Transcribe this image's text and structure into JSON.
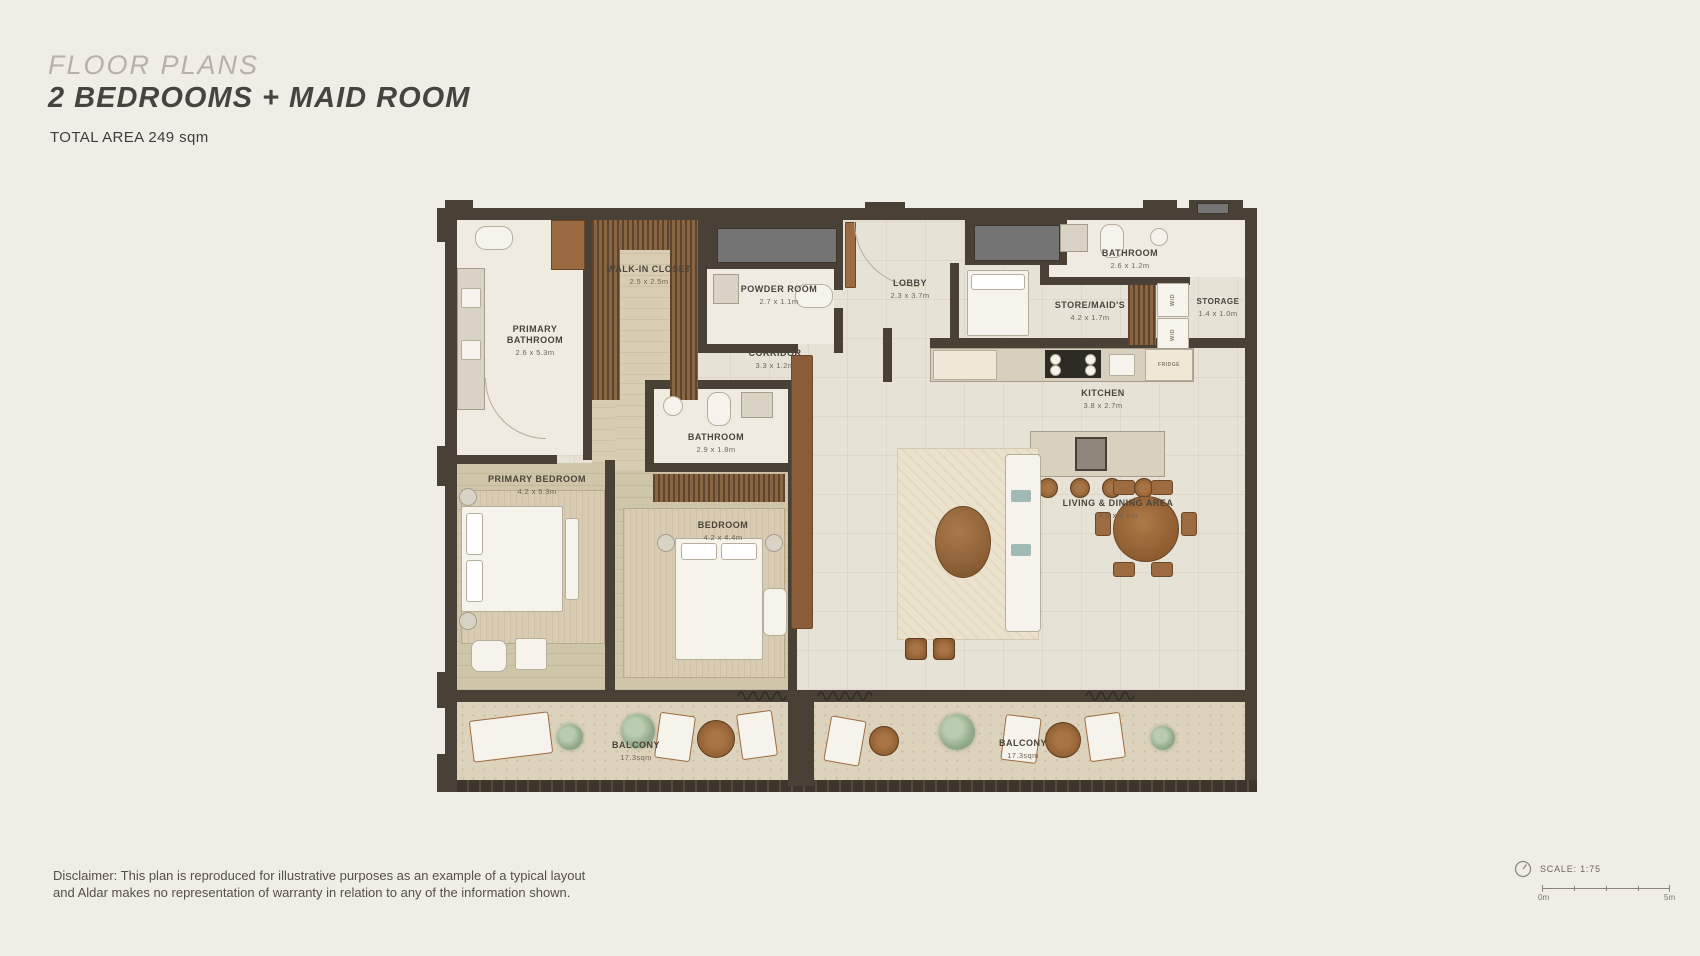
{
  "header": {
    "eyebrow": "FLOOR PLANS",
    "title": "2 BEDROOMS + MAID ROOM",
    "total_area": "TOTAL AREA 249 sqm"
  },
  "rooms": {
    "primary_bathroom": {
      "name": "PRIMARY BATHROOM",
      "dims": "2.6 x 5.3m"
    },
    "walk_in_closet": {
      "name": "WALK-IN CLOSET",
      "dims": "2.5 x 2.5m"
    },
    "powder_room": {
      "name": "POWDER ROOM",
      "dims": "2.7 x 1.1m"
    },
    "lobby": {
      "name": "LOBBY",
      "dims": "2.3 x 3.7m"
    },
    "maid_bathroom": {
      "name": "BATHROOM",
      "dims": "2.6 x 1.2m"
    },
    "store_maids": {
      "name": "STORE/MAID'S",
      "dims": "4.2 x 1.7m"
    },
    "storage": {
      "name": "STORAGE",
      "dims": "1.4 x 1.0m"
    },
    "corridor": {
      "name": "CORRIDOR",
      "dims": "3.3 x 1.2m"
    },
    "kitchen": {
      "name": "KITCHEN",
      "dims": "3.8 x 2.7m"
    },
    "bathroom": {
      "name": "BATHROOM",
      "dims": "2.9 x 1.8m"
    },
    "primary_bedroom": {
      "name": "PRIMARY BEDROOM",
      "dims": "4.2 x 5.3m"
    },
    "bedroom": {
      "name": "BEDROOM",
      "dims": "4.2 x 4.4m"
    },
    "living_dining": {
      "name": "LIVING & DINING AREA",
      "dims": "4.9 x 8.6m"
    },
    "balcony_left": {
      "name": "BALCONY",
      "dims": "17.3sqm"
    },
    "balcony_right": {
      "name": "BALCONY",
      "dims": "17.3sqm"
    }
  },
  "appliances": {
    "washer_dryer_top": "W/D",
    "washer_dryer_bottom": "W/D",
    "fridge": "FRIDGE"
  },
  "footer": {
    "disclaimer_line1": "Disclaimer: This plan is reproduced for illustrative purposes as an example of a typical layout",
    "disclaimer_line2": "and Aldar makes no representation of warranty in relation to any of the information shown.",
    "scale_label": "SCALE: 1:75",
    "scale_start": "0m",
    "scale_end": "5m"
  },
  "colors": {
    "background": "#f0ede6",
    "wall": "#4a4136",
    "tile_floor": "#e7e2d6",
    "wood_floor": "#cfc5aa",
    "wood_joinery": "#7a5a3a",
    "balcony_floor": "#ddd3bd",
    "glass": "#747474",
    "label_text": "#4a443b"
  }
}
